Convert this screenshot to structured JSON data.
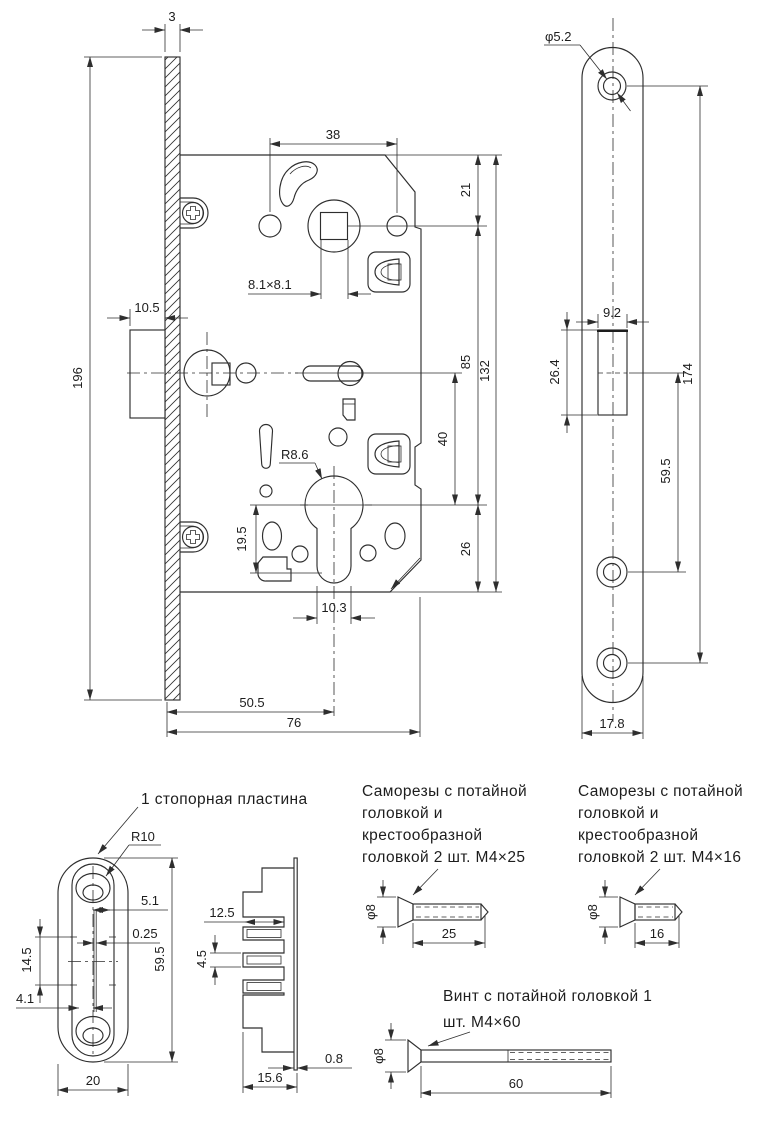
{
  "main_view": {
    "plate_thickness": "3",
    "plate_height": "196",
    "latch_protrusion": "10.5",
    "handle_hole_spacing": "38",
    "spindle_square": "8.1×8.1",
    "top_offset": "21",
    "center_distance": "85",
    "body_height": "132",
    "follower_spacing": "40",
    "bottom_offset": "26",
    "cylinder_radius": "R8.6",
    "keyway_height": "19.5",
    "keyway_width": "10.3",
    "backset": "50.5",
    "body_depth": "76"
  },
  "faceplate_view": {
    "hole_diameter": "φ5.2",
    "opening_width": "9.2",
    "opening_height": "26.4",
    "hole_span": "174",
    "lower_span": "59.5",
    "plate_width": "17.8"
  },
  "stop_plate": {
    "label": "1 стопорная пластина",
    "radius": "R10",
    "center_offset": "5.1",
    "gap": "0.25",
    "slot_height": "14.5",
    "edge_width": "4.1",
    "height": "59.5",
    "width": "20"
  },
  "stop_plate_side": {
    "depth": "12.5",
    "fin_pitch": "4.5",
    "total_depth": "15.6",
    "back_thickness": "0.8"
  },
  "screws": {
    "m4x25": {
      "line1": "Саморезы с потайной",
      "line2": "головкой и",
      "line3": "крестообразной",
      "line4": "головкой 2 шт. M4×25",
      "head": "φ8",
      "length": "25"
    },
    "m4x16": {
      "line1": "Саморезы с потайной",
      "line2": "головкой и",
      "line3": "крестообразной",
      "line4": "головкой 2 шт. M4×16",
      "head": "φ8",
      "length": "16"
    },
    "m4x60": {
      "line1": "Винт с потайной головкой 1",
      "line2": "шт. M4×60",
      "head": "φ8",
      "length": "60"
    }
  },
  "colors": {
    "line": "#2e2e2e",
    "text": "#1d1d1d",
    "background": "#ffffff"
  }
}
